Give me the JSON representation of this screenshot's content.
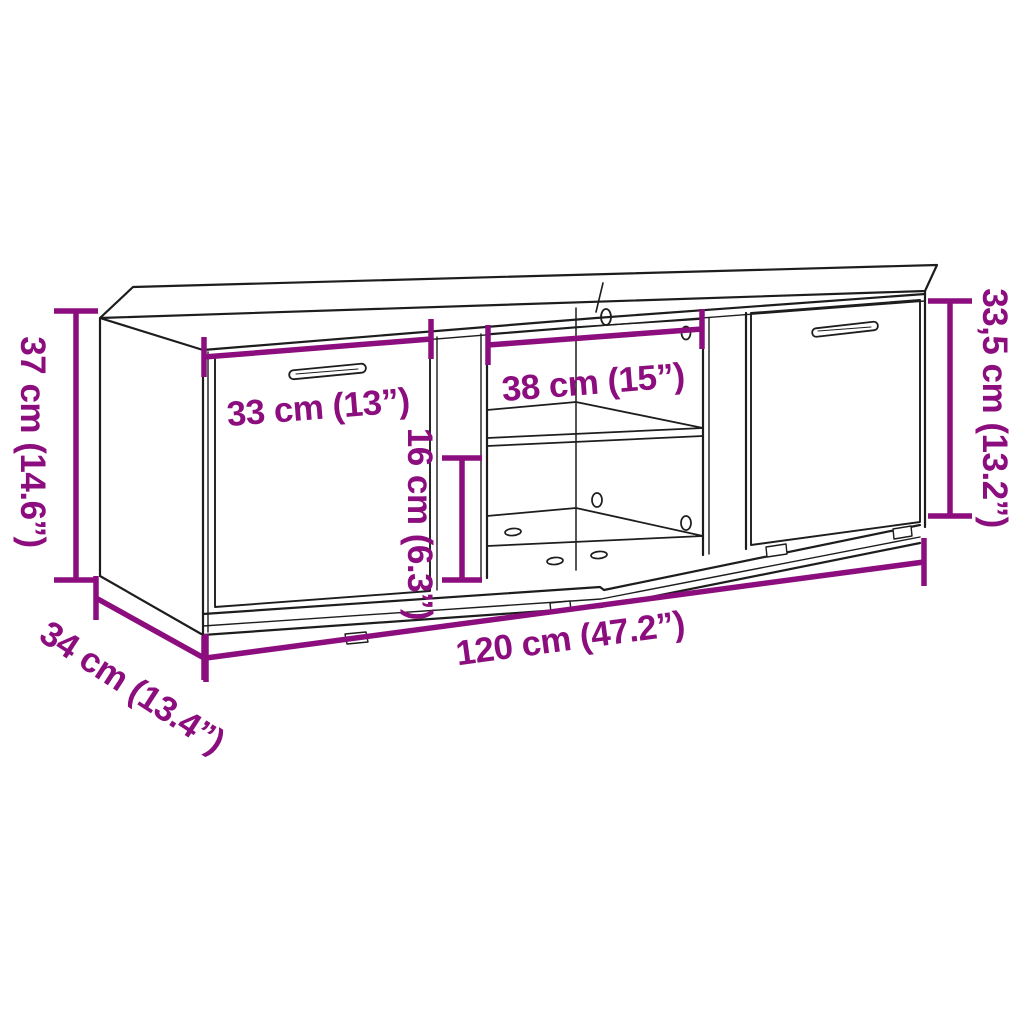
{
  "meta": {
    "title": "TV cabinet dimension diagram",
    "product": "TV cabinet line drawing with measurements"
  },
  "colors": {
    "dimension": "#8C0E7E",
    "line": "#1d1d1d",
    "background": "#ffffff"
  },
  "dimensions": {
    "height_left": "37 cm (14.6”)",
    "door_width": "33 cm (13”)",
    "middle_compartment_width": "38 cm (15”)",
    "lower_compartment_height": "16 cm (6.3”)",
    "height_right": "33,5 cm (13.2”)",
    "total_width": "120 cm (47.2”)",
    "depth": "34 cm (13.4”)"
  }
}
